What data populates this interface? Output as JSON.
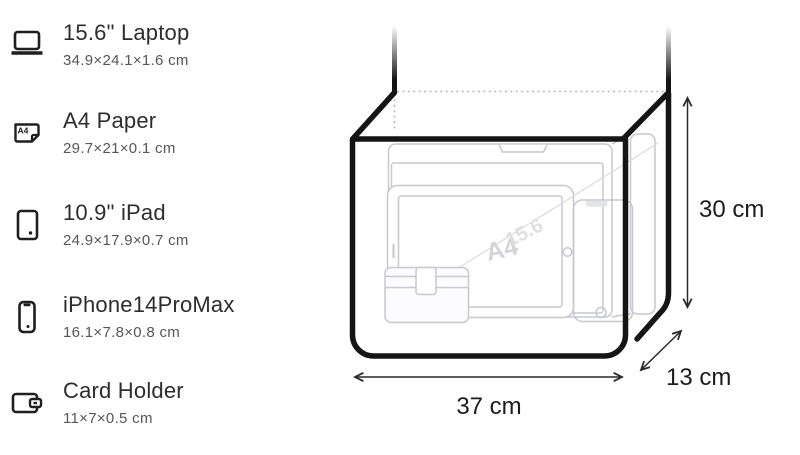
{
  "sidebar": {
    "items": [
      {
        "title": "15.6\" Laptop",
        "dims": "34.9×24.1×1.6 cm",
        "icon": "laptop-icon"
      },
      {
        "title": "A4 Paper",
        "dims": "29.7×21×0.1 cm",
        "icon": "a4-paper-icon"
      },
      {
        "title": "10.9\" iPad",
        "dims": "24.9×17.9×0.7 cm",
        "icon": "ipad-icon"
      },
      {
        "title": "iPhone14ProMax",
        "dims": "16.1×7.8×0.8 cm",
        "icon": "iphone-icon"
      },
      {
        "title": "Card Holder",
        "dims": "11×7×0.5 cm",
        "icon": "card-holder-icon"
      }
    ]
  },
  "diagram": {
    "width_label": "37 cm",
    "height_label": "30 cm",
    "depth_label": "13 cm",
    "watermark_a4": "A4",
    "watermark_laptop": "15.6"
  },
  "icons": {
    "a4_badge": "A4"
  },
  "colors": {
    "bag_outline": "#151515",
    "ghost_line": "#c7c8d0",
    "dimension_text": "#1c1c1c",
    "secondary_text": "#56565c"
  }
}
